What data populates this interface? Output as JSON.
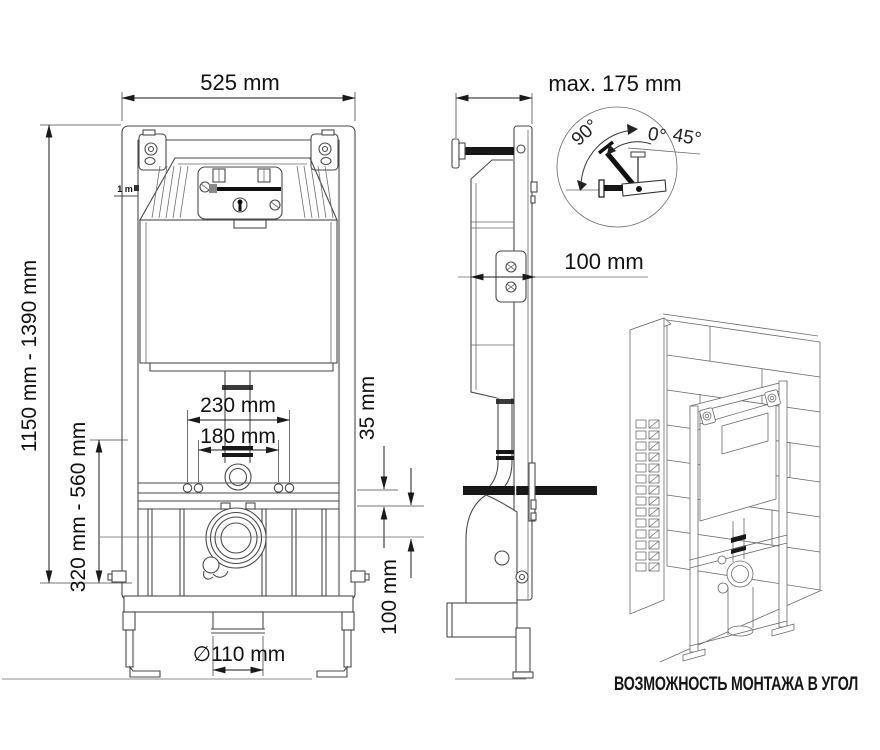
{
  "drawing": {
    "front": {
      "width": "525 mm",
      "full_height": "1150 mm - 1390 mm",
      "lower_height": "320 mm - 560 mm",
      "fixing_outer": "230 mm",
      "fixing_inner": "180 mm",
      "offset": "35 mm",
      "outlet_center_height": "100 mm",
      "outlet_diameter": "∅110 mm",
      "height_mark": "1 m"
    },
    "side": {
      "depth": "max. 175 mm",
      "wall_distance": "100 mm",
      "bracket_angles": {
        "left": "90°",
        "mid": "0°",
        "right": "45°"
      }
    },
    "corner": {
      "caption": "ВОЗМОЖНОСТЬ МОНТАЖА В УГОЛ"
    }
  },
  "colors": {
    "line": "#4a4a4a",
    "dark": "#181818",
    "background": "#ffffff"
  }
}
